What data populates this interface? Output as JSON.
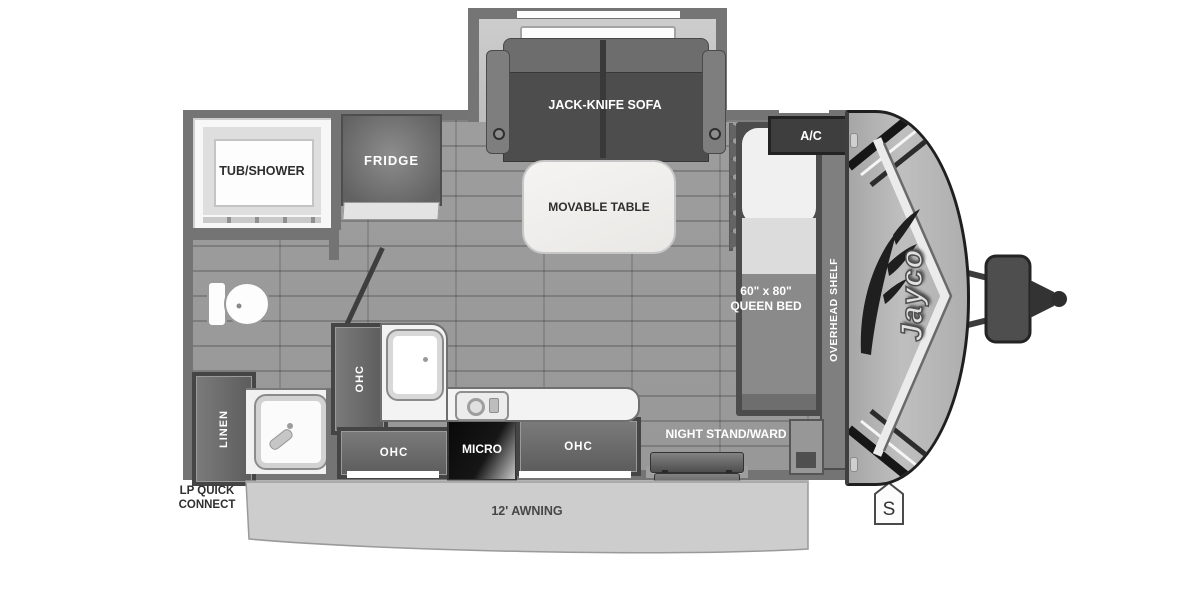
{
  "floorplan": {
    "brand": "Jayco",
    "labels": {
      "sofa": "JACK-KNIFE SOFA",
      "table": "MOVABLE TABLE",
      "tub": "TUB/SHOWER",
      "fridge": "FRIDGE",
      "ac": "A/C",
      "overhead_shelf": "OVERHEAD SHELF",
      "bed_line1": "60\" x 80\"",
      "bed_line2": "QUEEN BED",
      "ohc": "OHC",
      "micro": "MICRO",
      "linen": "LINEN",
      "night_stand": "NIGHT STAND/WARD",
      "awning": "12' AWNING",
      "lp_line1": "LP QUICK",
      "lp_line2": "CONNECT",
      "spare_badge": "S"
    },
    "colors": {
      "wall": "#747474",
      "floor": "#9c9c9c",
      "cabinet": "#5c5c5c",
      "counter": "#f3f3f3",
      "micro": "#161616",
      "front_cap": "#b5b5b5",
      "awning": "#cccccc",
      "label_light": "#ffffff",
      "label_dark": "#2e2e2e"
    }
  }
}
